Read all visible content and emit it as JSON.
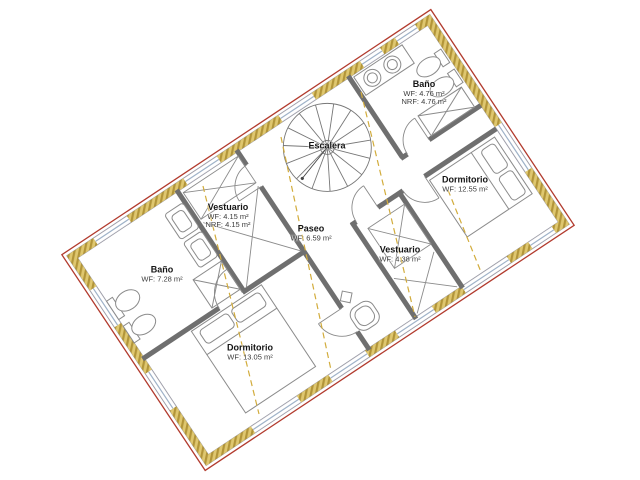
{
  "app": {
    "view_title": "Floor plan – upper level"
  },
  "rooms": {
    "vestuario_left": {
      "name": "Vestuario",
      "wf": "WF: 4.15 m²",
      "nrf": "NRF: 4.15 m²"
    },
    "bano_left": {
      "name": "Baño",
      "wf": "WF: 7.28 m²"
    },
    "dormitorio_bottom": {
      "name": "Dormitorio",
      "wf": "WF: 13.05 m²"
    },
    "escalera": {
      "name": "Escalera"
    },
    "paseo": {
      "name": "Paseo",
      "wf": "WF: 6.59 m²"
    },
    "vestuario_right": {
      "name": "Vestuario",
      "wf": "WF: 4.38 m²"
    },
    "bano_right": {
      "name": "Baño",
      "wf": "WF: 4.76 m²",
      "nrf": "NRF: 4.76 m²"
    },
    "dormitorio_right": {
      "name": "Dormitorio",
      "wf": "WF: 12.55 m²"
    }
  },
  "colors": {
    "outline_red": "#b23b2e",
    "wall_hatch_gold": "#dfc76f",
    "wall_hatch_dark": "#b29539",
    "interior_wall_gray": "#6f6f6f",
    "window_blue_gray": "#9fb2c8",
    "section_line_gold": "#d2ac3c"
  }
}
